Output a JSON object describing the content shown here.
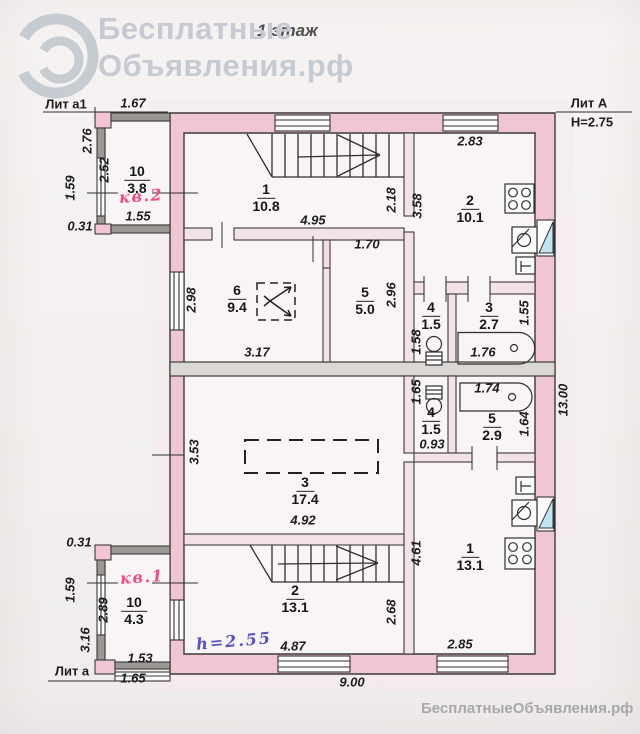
{
  "watermark": {
    "brand_line1": "Бесплатные",
    "brand_line2": "Объявления.рф",
    "floor_label": "1 этаж",
    "footer": "БесплатныеОбъявления.рф"
  },
  "titles": {
    "lit_a1": "Лит а1",
    "lit_A": "Лит А",
    "height_main": "Н=2.75",
    "lit_a": "Лит а",
    "apt2": "кв.2",
    "apt1": "кв.1",
    "height_note": "h=2.55"
  },
  "rooms": {
    "r10_top": {
      "num": "10",
      "area": "3.8"
    },
    "r1_top": {
      "num": "1",
      "area": "10.8"
    },
    "r2_top": {
      "num": "2",
      "area": "10.1"
    },
    "r6": {
      "num": "6",
      "area": "9.4"
    },
    "r5_top": {
      "num": "5",
      "area": "5.0"
    },
    "r4_top": {
      "num": "4",
      "area": "1.5"
    },
    "r3_top": {
      "num": "3",
      "area": "2.7"
    },
    "r3_big": {
      "num": "3",
      "area": "17.4"
    },
    "r4_bot": {
      "num": "4",
      "area": "1.5"
    },
    "r5_bot": {
      "num": "5",
      "area": "2.9"
    },
    "r1_bot": {
      "num": "1",
      "area": "13.1"
    },
    "r2_bot": {
      "num": "2",
      "area": "13.1"
    },
    "r10_bot": {
      "num": "10",
      "area": "4.3"
    }
  },
  "dims": {
    "top_annex_width": "1.67",
    "annex_left_height": "2.76",
    "annex_inner_height": "2.52",
    "annex_porch": "1.59",
    "annex_offset_top": "0.31",
    "annex_inner_width": "1.55",
    "room1_width": "4.95",
    "room1_right": "2.18",
    "kitchen2_left": "3.58",
    "kitchen2_top": "2.83",
    "room6_left": "2.98",
    "room6_width": "3.17",
    "room5_top": "1.70",
    "room5_right": "2.96",
    "wc2_left": "1.58",
    "bath2_right": "1.55",
    "bath2_width": "1.76",
    "bath1_width": "1.74",
    "wc1_left": "1.65",
    "bath1_right": "1.64",
    "wc1_bottom": "0.93",
    "room3_left": "3.53",
    "room3_width": "4.92",
    "house_right": "13.00",
    "kitchen1_left": "4.61",
    "room2_right": "2.68",
    "room2_width": "4.87",
    "kitchen1_bottom": "2.85",
    "annexb_offset": "0.31",
    "annexb_porch": "1.59",
    "annexb_left": "3.16",
    "annexb_inner": "2.89",
    "annexb_width_top": "1.53",
    "annexb_width": "1.65",
    "house_bottom": "9.00"
  }
}
